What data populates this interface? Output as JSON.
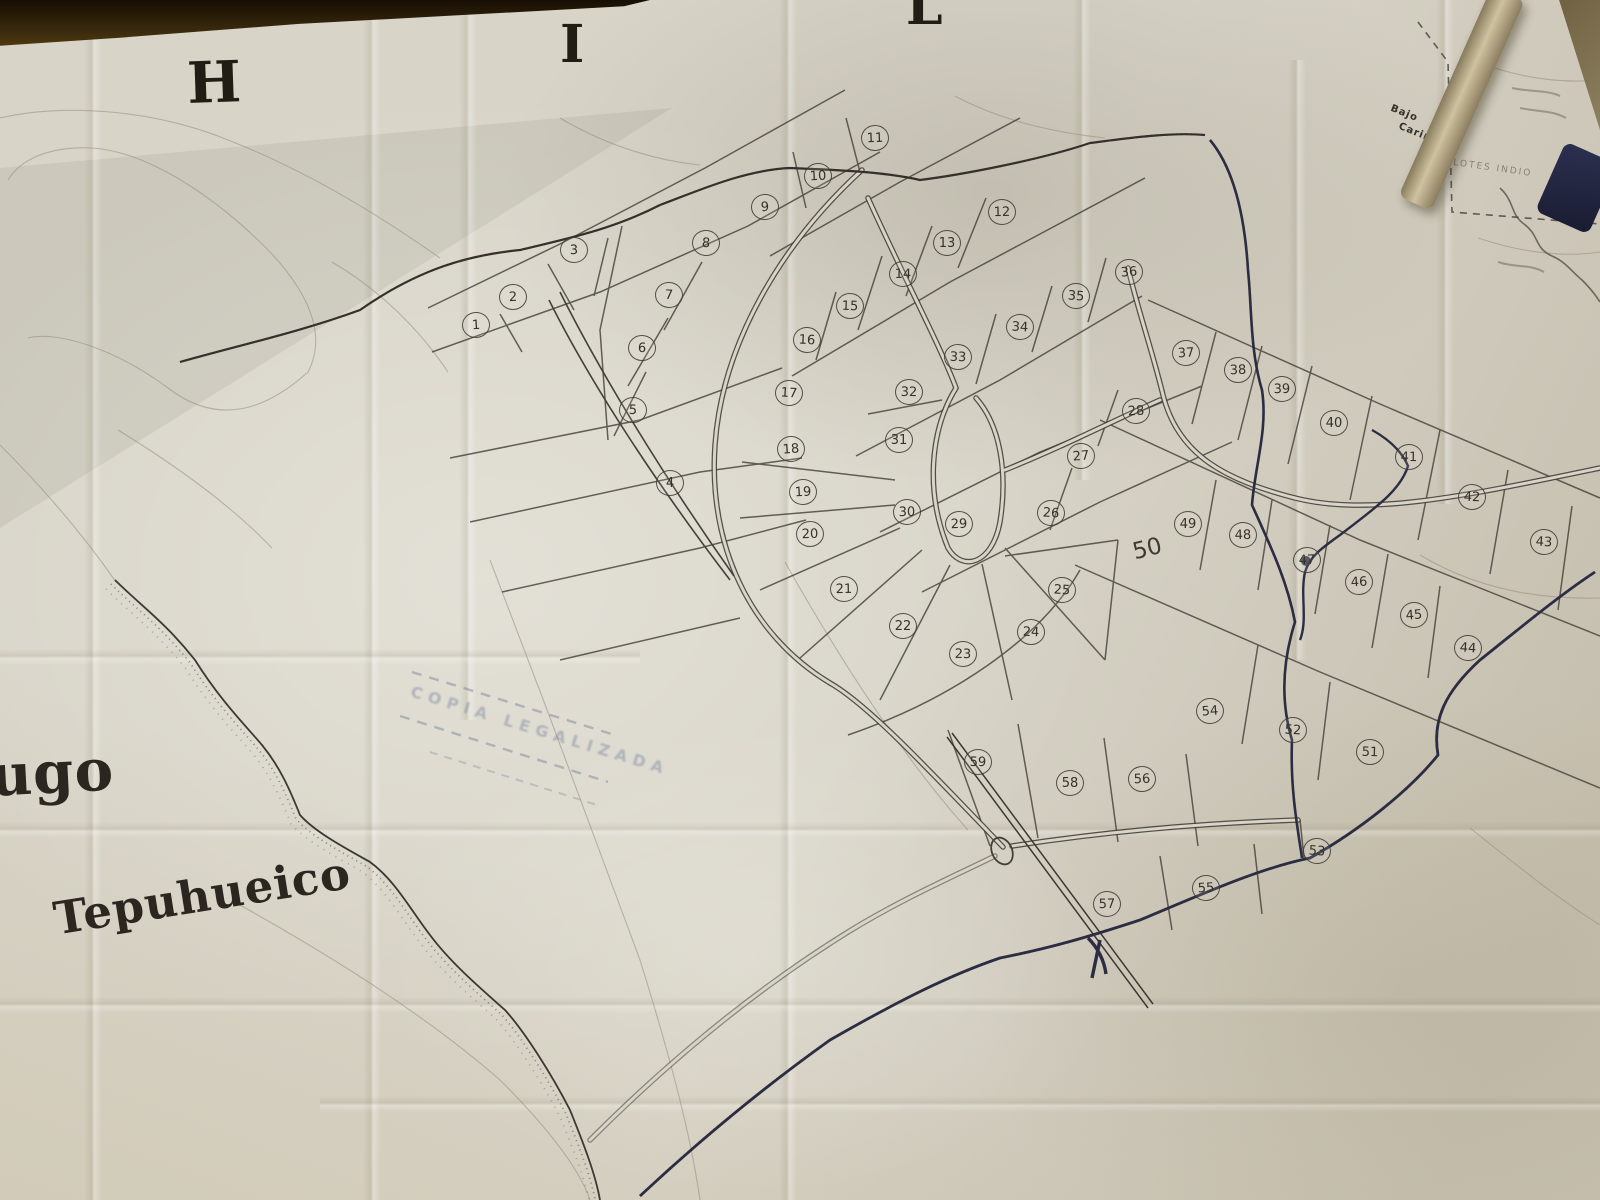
{
  "map": {
    "colors": {
      "paper": "#d8d4c8",
      "ink": "#3f3b35",
      "pen_ink": "#2c2d42",
      "wood": "#2e2008",
      "roller_wood": "#cfc2a0",
      "dark_object": "#22263c"
    },
    "texts": {
      "title_letters": [
        {
          "t": "H",
          "x": 186,
          "y": 50,
          "s": 57,
          "r": -2
        },
        {
          "t": "I",
          "x": 560,
          "y": 14,
          "s": 52,
          "r": 0
        },
        {
          "t": "L",
          "x": 906,
          "y": -24,
          "s": 52,
          "r": 0
        }
      ],
      "places": [
        {
          "t": "ugo",
          "x": -12,
          "y": 742,
          "s": 58,
          "r": -3
        },
        {
          "t": "Tepuhueico",
          "x": 50,
          "y": 893,
          "s": 45,
          "r": -9
        }
      ],
      "inset": [
        {
          "t": "Bajo",
          "x": 1393,
          "y": 103,
          "s": 10,
          "r": 22
        },
        {
          "t": "Carimo",
          "x": 1401,
          "y": 121,
          "s": 10,
          "r": 22
        }
      ],
      "inset_faint": [
        {
          "t": "LOTES INDIO",
          "x": 1454,
          "y": 158,
          "s": 9,
          "r": 8
        }
      ],
      "stamp": {
        "t": "COPIA LEGALIZADA",
        "x": 414,
        "y": 682,
        "s": 16,
        "r": 17
      },
      "area50": {
        "t": "50",
        "x": 1130,
        "y": 540,
        "s": 23,
        "r": -14
      }
    },
    "parcels": [
      {
        "n": "1",
        "x": 476,
        "y": 325
      },
      {
        "n": "2",
        "x": 513,
        "y": 297
      },
      {
        "n": "3",
        "x": 574,
        "y": 250
      },
      {
        "n": "4",
        "x": 670,
        "y": 483
      },
      {
        "n": "5",
        "x": 633,
        "y": 410
      },
      {
        "n": "6",
        "x": 642,
        "y": 348
      },
      {
        "n": "7",
        "x": 669,
        "y": 295
      },
      {
        "n": "8",
        "x": 706,
        "y": 243
      },
      {
        "n": "9",
        "x": 765,
        "y": 207
      },
      {
        "n": "10",
        "x": 818,
        "y": 176
      },
      {
        "n": "11",
        "x": 875,
        "y": 138
      },
      {
        "n": "12",
        "x": 1002,
        "y": 212
      },
      {
        "n": "13",
        "x": 947,
        "y": 243
      },
      {
        "n": "14",
        "x": 903,
        "y": 274
      },
      {
        "n": "15",
        "x": 850,
        "y": 306
      },
      {
        "n": "16",
        "x": 807,
        "y": 340
      },
      {
        "n": "17",
        "x": 789,
        "y": 393
      },
      {
        "n": "18",
        "x": 791,
        "y": 449
      },
      {
        "n": "19",
        "x": 803,
        "y": 492
      },
      {
        "n": "20",
        "x": 810,
        "y": 534
      },
      {
        "n": "21",
        "x": 844,
        "y": 589
      },
      {
        "n": "22",
        "x": 903,
        "y": 626
      },
      {
        "n": "23",
        "x": 963,
        "y": 654
      },
      {
        "n": "24",
        "x": 1031,
        "y": 632
      },
      {
        "n": "25",
        "x": 1062,
        "y": 590
      },
      {
        "n": "26",
        "x": 1051,
        "y": 513
      },
      {
        "n": "27",
        "x": 1081,
        "y": 456
      },
      {
        "n": "28",
        "x": 1136,
        "y": 411
      },
      {
        "n": "29",
        "x": 959,
        "y": 524
      },
      {
        "n": "30",
        "x": 907,
        "y": 512
      },
      {
        "n": "31",
        "x": 899,
        "y": 440
      },
      {
        "n": "32",
        "x": 909,
        "y": 392
      },
      {
        "n": "33",
        "x": 958,
        "y": 357
      },
      {
        "n": "34",
        "x": 1020,
        "y": 327
      },
      {
        "n": "35",
        "x": 1076,
        "y": 296
      },
      {
        "n": "36",
        "x": 1129,
        "y": 272
      },
      {
        "n": "37",
        "x": 1186,
        "y": 353
      },
      {
        "n": "38",
        "x": 1238,
        "y": 370
      },
      {
        "n": "39",
        "x": 1282,
        "y": 389
      },
      {
        "n": "40",
        "x": 1334,
        "y": 423
      },
      {
        "n": "41",
        "x": 1409,
        "y": 457
      },
      {
        "n": "42",
        "x": 1472,
        "y": 497
      },
      {
        "n": "43",
        "x": 1544,
        "y": 542
      },
      {
        "n": "44",
        "x": 1468,
        "y": 648
      },
      {
        "n": "45",
        "x": 1414,
        "y": 615
      },
      {
        "n": "46",
        "x": 1359,
        "y": 582
      },
      {
        "n": "47",
        "x": 1307,
        "y": 560
      },
      {
        "n": "48",
        "x": 1243,
        "y": 535
      },
      {
        "n": "49",
        "x": 1188,
        "y": 524
      },
      {
        "n": "51",
        "x": 1370,
        "y": 752
      },
      {
        "n": "52",
        "x": 1293,
        "y": 730
      },
      {
        "n": "53",
        "x": 1317,
        "y": 851
      },
      {
        "n": "54",
        "x": 1210,
        "y": 711
      },
      {
        "n": "55",
        "x": 1206,
        "y": 888
      },
      {
        "n": "56",
        "x": 1142,
        "y": 779
      },
      {
        "n": "57",
        "x": 1107,
        "y": 904
      },
      {
        "n": "58",
        "x": 1070,
        "y": 783
      },
      {
        "n": "59",
        "x": 978,
        "y": 762
      }
    ]
  }
}
